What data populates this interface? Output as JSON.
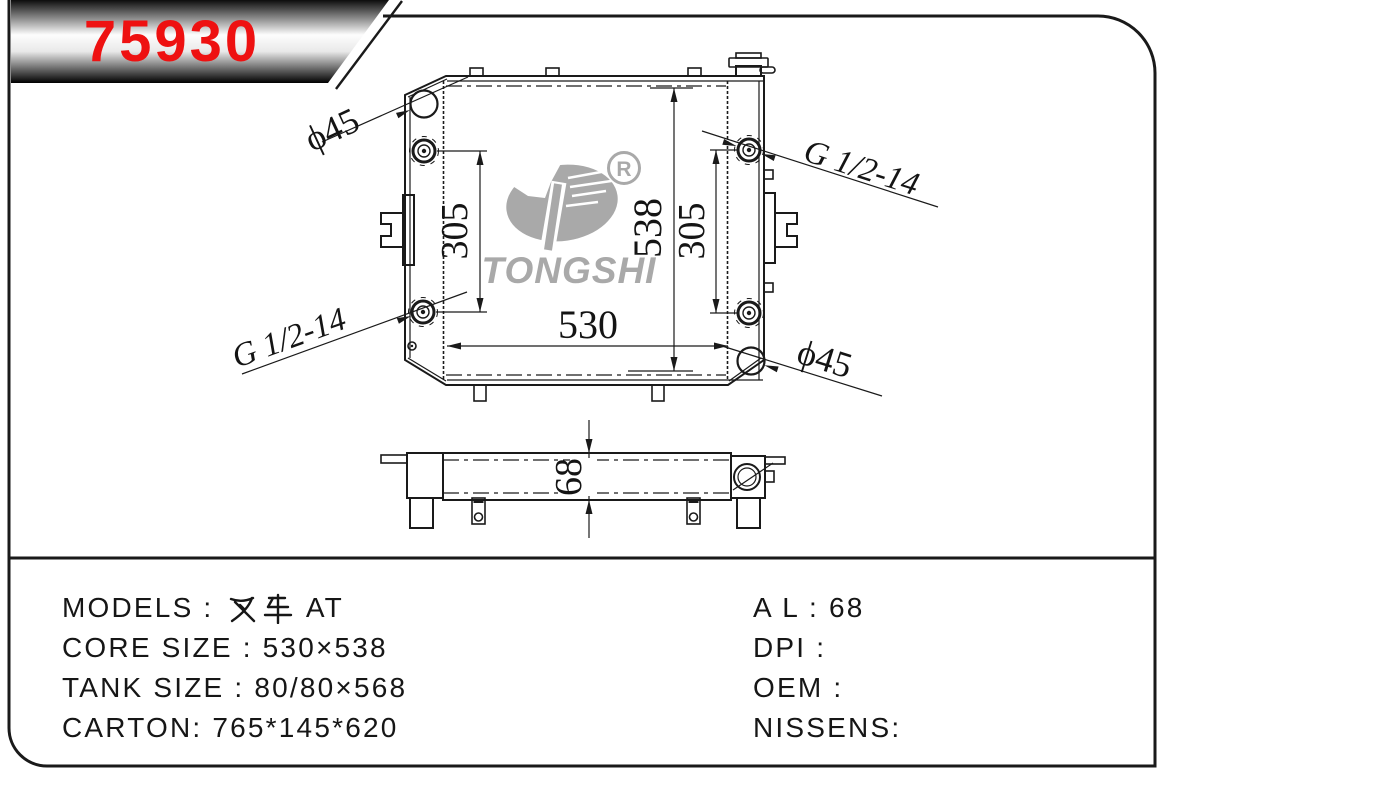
{
  "banner": {
    "part_number": "75930",
    "accent_color": "#ee1111"
  },
  "logo": {
    "brand": "TONGSHI",
    "registered_mark": "R",
    "color": "#a9a9a9"
  },
  "dimensions": {
    "hole_top_left": "ϕ45",
    "thread_top_right": "G 1/2-14",
    "thread_bottom_left": "G 1/2-14",
    "hole_bottom_right": "ϕ45",
    "core_width": "530",
    "core_height": "538",
    "port_pitch_left": "305",
    "port_pitch_right": "305",
    "core_thickness": "68"
  },
  "specs": {
    "models_label": "MODELS : ",
    "models_value_cjk": "叉车",
    "models_value_rest": " AT",
    "core_size": "CORE SIZE : 530×538",
    "tank_size": "TANK SIZE : 80/80×568",
    "carton": "CARTON: 765*145*620",
    "al": "A L : 68",
    "dpi": "DPI :",
    "oem": "OEM :",
    "nissens": "NISSENS:"
  },
  "colors": {
    "line": "#1a1a1a",
    "logo_gray": "#a9a9a9"
  }
}
